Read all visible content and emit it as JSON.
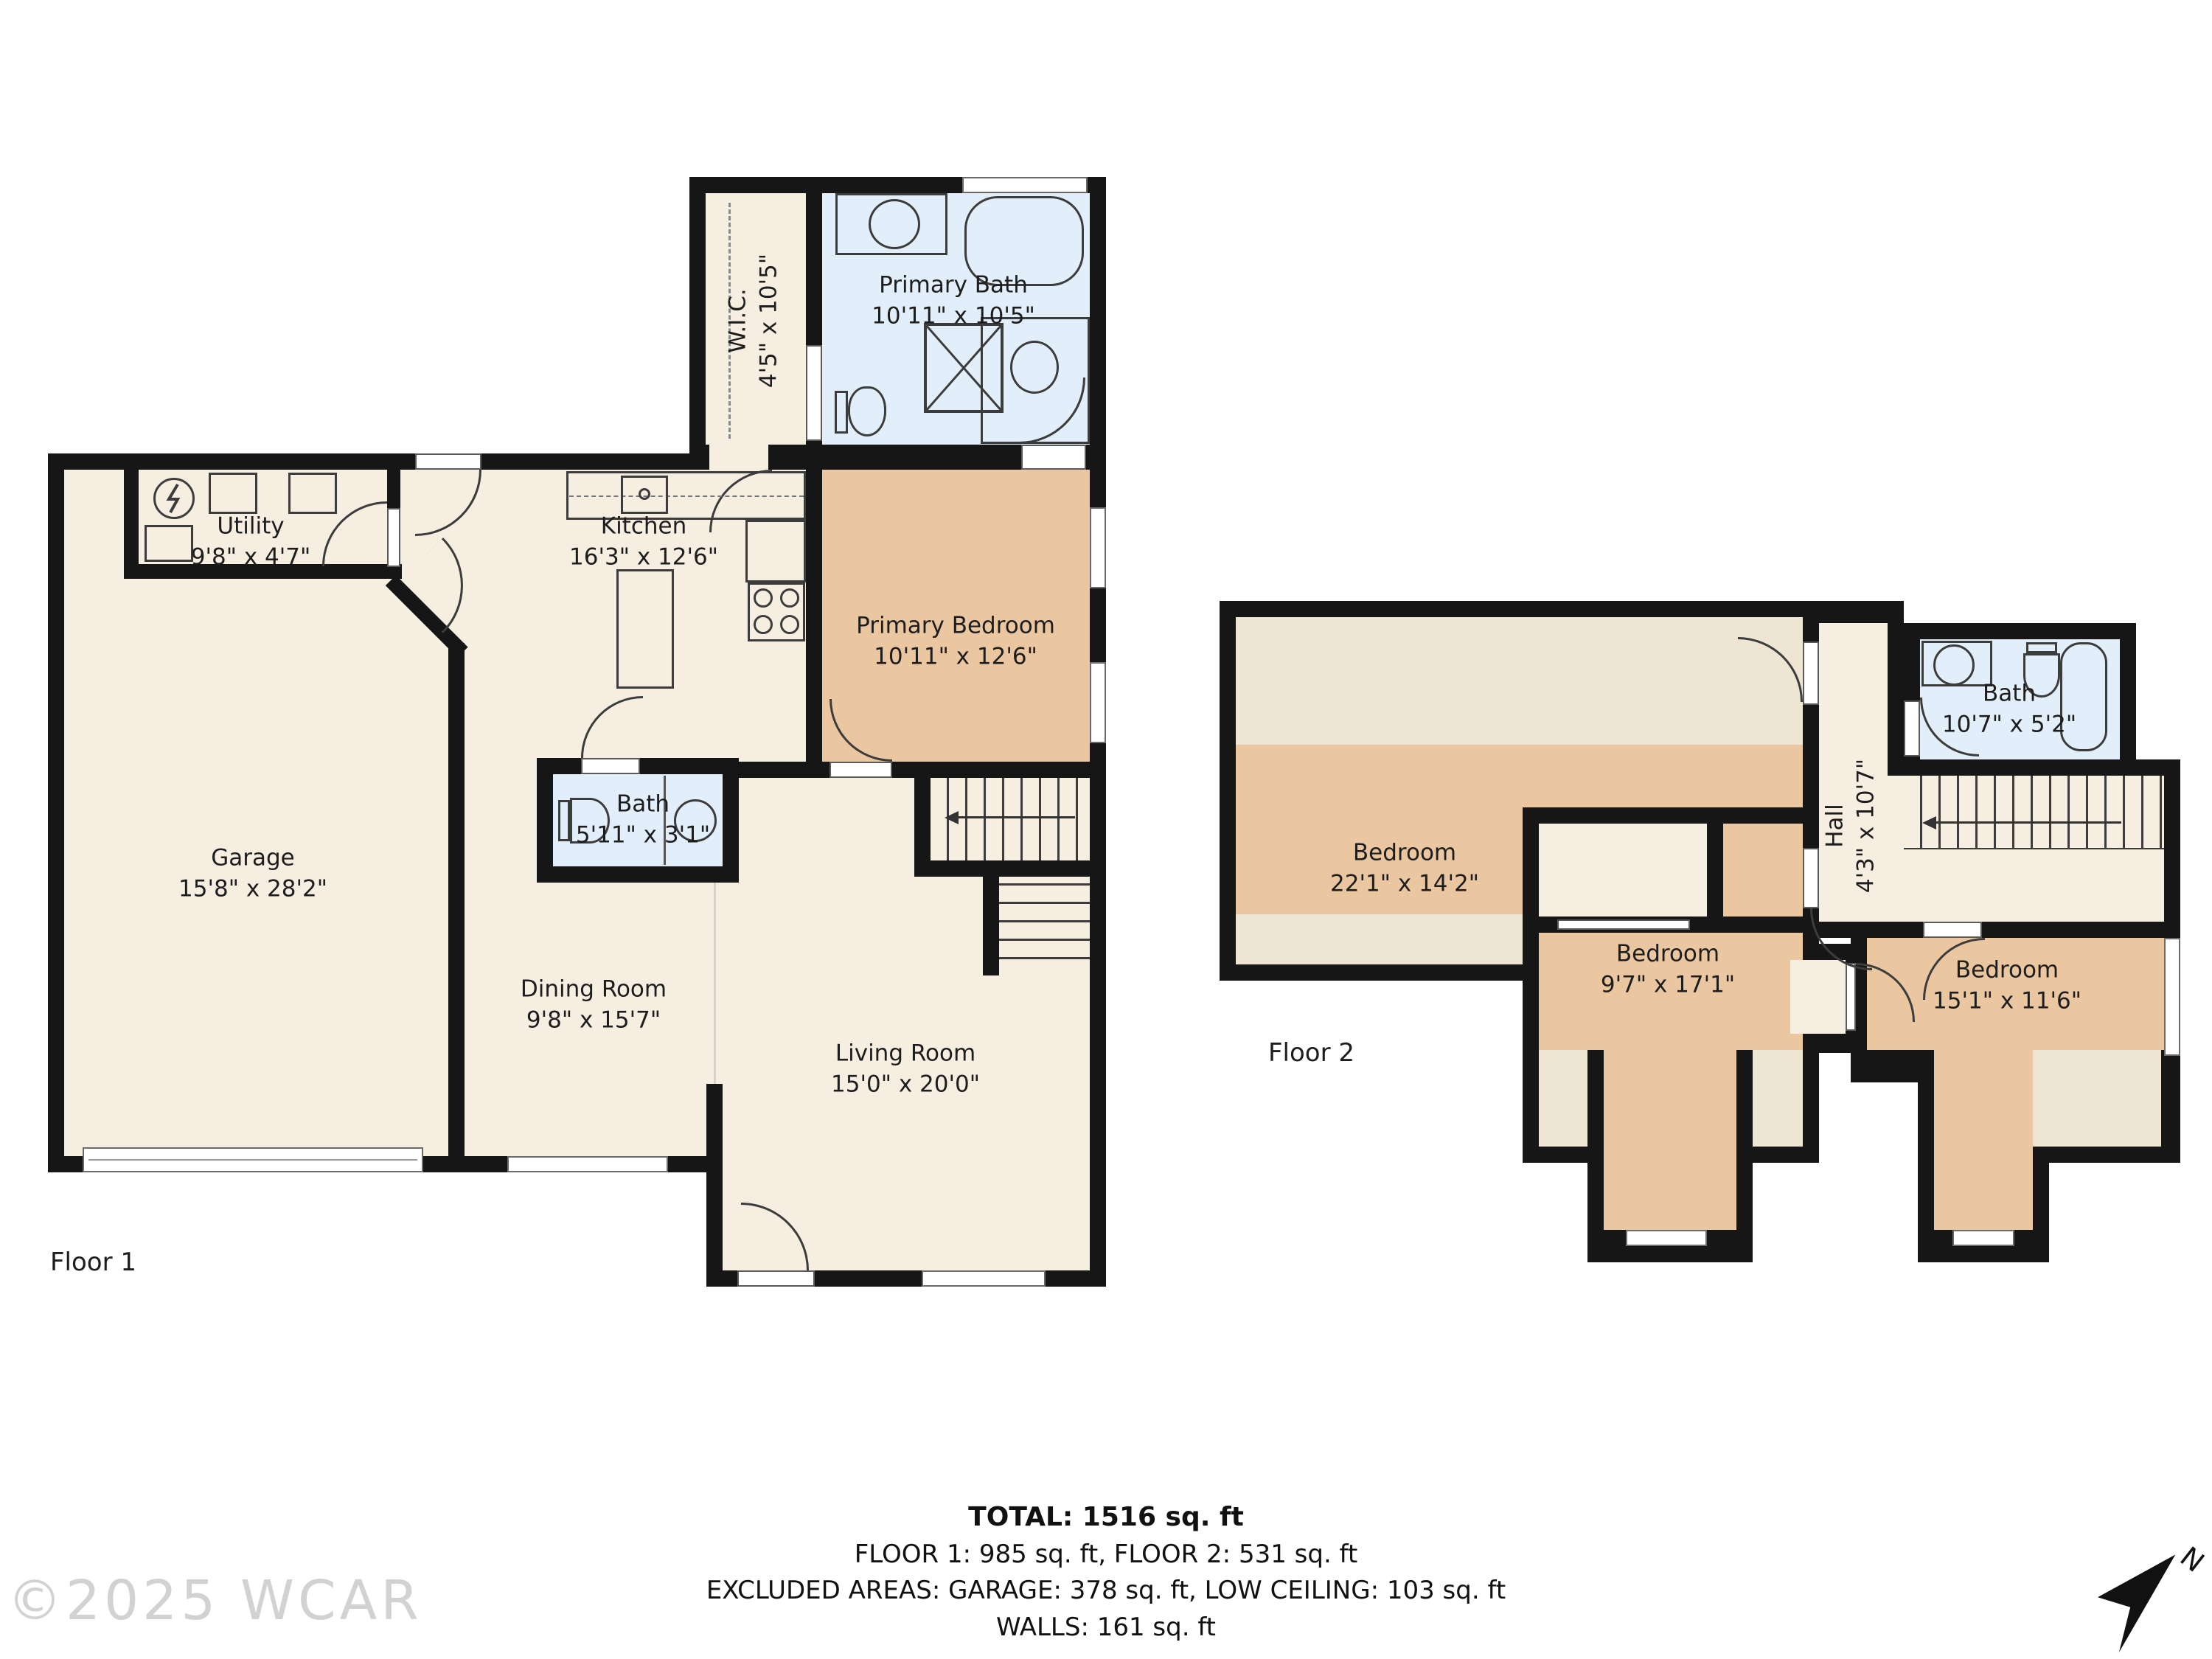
{
  "floor1": {
    "label": "Floor 1",
    "rooms": [
      {
        "id": "wic",
        "name": "W.I.C.",
        "dims": "4'5\" x 10'5\""
      },
      {
        "id": "primary_bath",
        "name": "Primary Bath",
        "dims": "10'11\" x 10'5\""
      },
      {
        "id": "utility",
        "name": "Utility",
        "dims": "9'8\" x 4'7\""
      },
      {
        "id": "kitchen",
        "name": "Kitchen",
        "dims": "16'3\" x 12'6\""
      },
      {
        "id": "primary_bedroom",
        "name": "Primary Bedroom",
        "dims": "10'11\" x 12'6\""
      },
      {
        "id": "garage",
        "name": "Garage",
        "dims": "15'8\" x 28'2\""
      },
      {
        "id": "bath",
        "name": "Bath",
        "dims": "5'11\" x 3'1\""
      },
      {
        "id": "dining_room",
        "name": "Dining Room",
        "dims": "9'8\" x 15'7\""
      },
      {
        "id": "living_room",
        "name": "Living Room",
        "dims": "15'0\" x 20'0\""
      }
    ]
  },
  "floor2": {
    "label": "Floor 2",
    "rooms": [
      {
        "id": "bedroom_large",
        "name": "Bedroom",
        "dims": "22'1\" x 14'2\""
      },
      {
        "id": "hall",
        "name": "Hall",
        "dims": "4'3\" x 10'7\""
      },
      {
        "id": "bath2",
        "name": "Bath",
        "dims": "10'7\" x 5'2\""
      },
      {
        "id": "bedroom_mid",
        "name": "Bedroom",
        "dims": "9'7\" x 17'1\""
      },
      {
        "id": "bedroom_right",
        "name": "Bedroom",
        "dims": "15'1\" x 11'6\""
      }
    ]
  },
  "footer": {
    "total": "TOTAL: 1516 sq. ft",
    "floors": "FLOOR 1: 985 sq. ft, FLOOR 2: 531 sq. ft",
    "excluded": "EXCLUDED AREAS: GARAGE: 378 sq. ft, LOW CEILING: 103 sq. ft",
    "walls": "WALLS: 161 sq. ft",
    "disclaimer": "Floor Plan Created By Cubicasa App. Measurements Deemed Highly Reliable But Not Guaranteed."
  },
  "watermark": "©2025 WCAR",
  "compass": {
    "north_label": "N"
  },
  "colors": {
    "room_fill": "#f6eee1",
    "bedroom_fill": "#eac7a1",
    "bath_fill": "#e2effa",
    "low_ceiling_fill": "#efe5d3",
    "wall": "#161616"
  }
}
